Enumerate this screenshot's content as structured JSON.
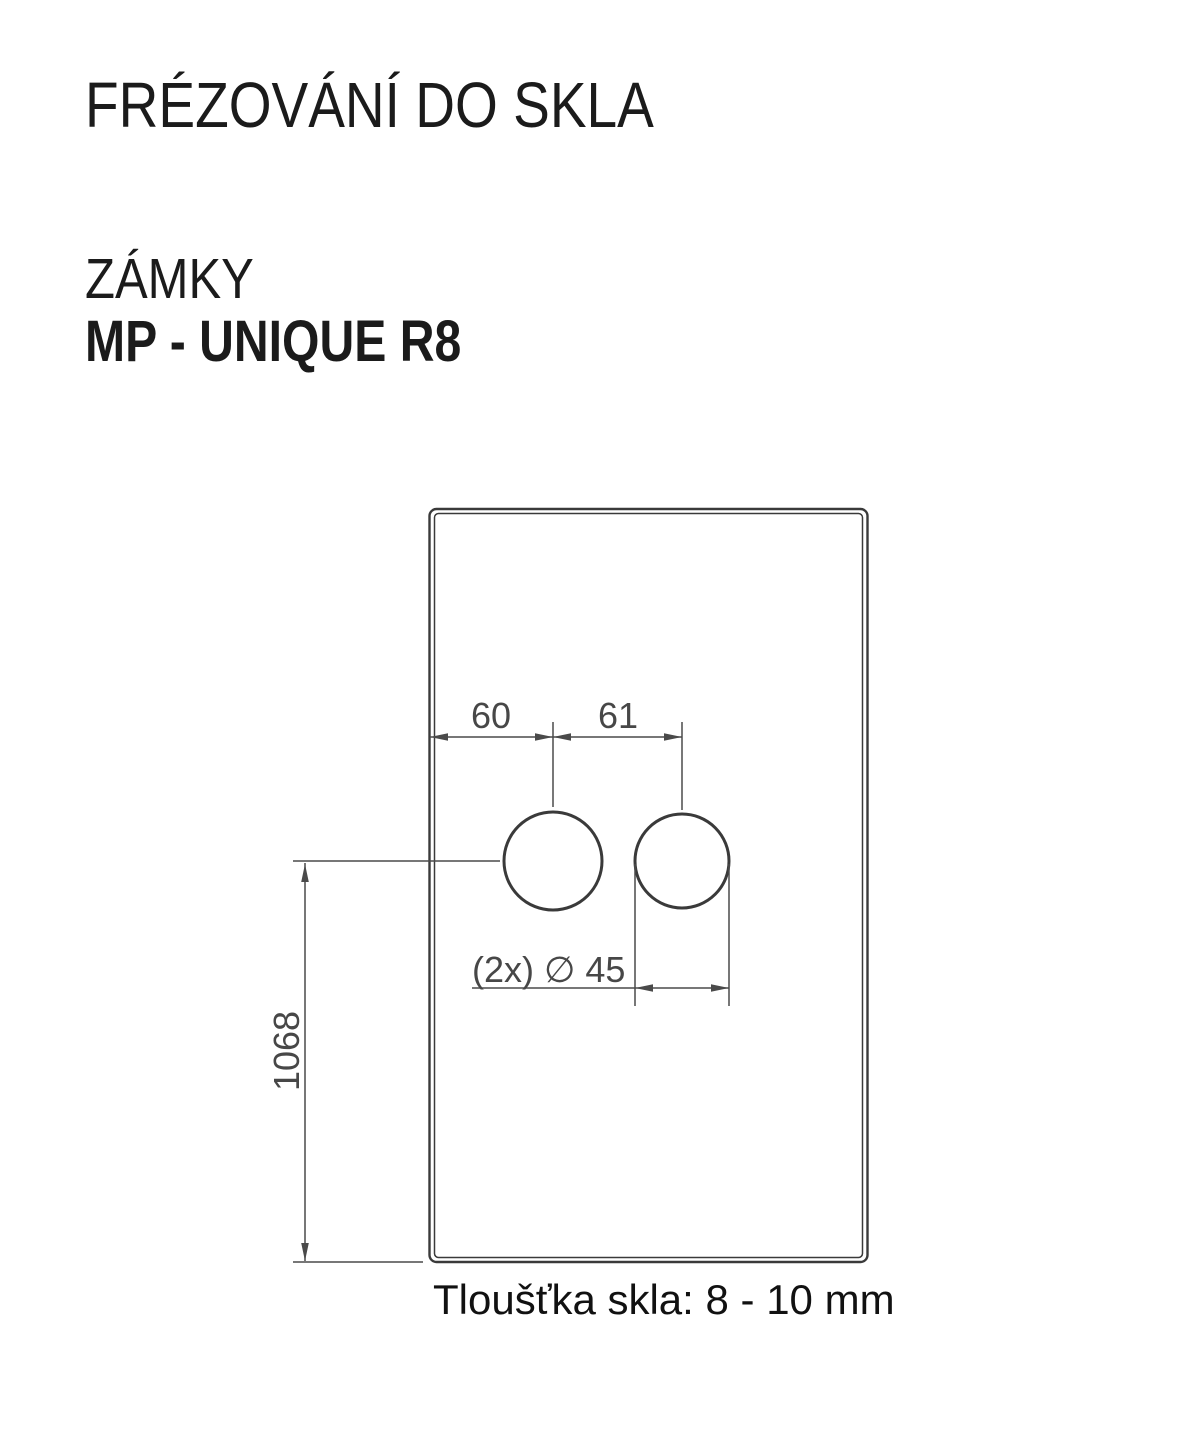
{
  "header": {
    "title": "FRÉZOVÁNÍ DO SKLA",
    "category": "ZÁMKY",
    "model": "MP - UNIQUE R8"
  },
  "drawing": {
    "labels": {
      "edge_to_first_hole": "60",
      "hole_axis_spacing": "61",
      "hole_diameter": "(2x) ∅ 45",
      "bottom_to_hole_axis": "1068"
    },
    "caption": "Tloušťka skla: 8 - 10 mm",
    "colors": {
      "glass_outline": "#3a3a3a",
      "dimension_lines": "#4a4a4a",
      "dimension_text": "#474747",
      "heading_text": "#1b1b1b"
    }
  }
}
